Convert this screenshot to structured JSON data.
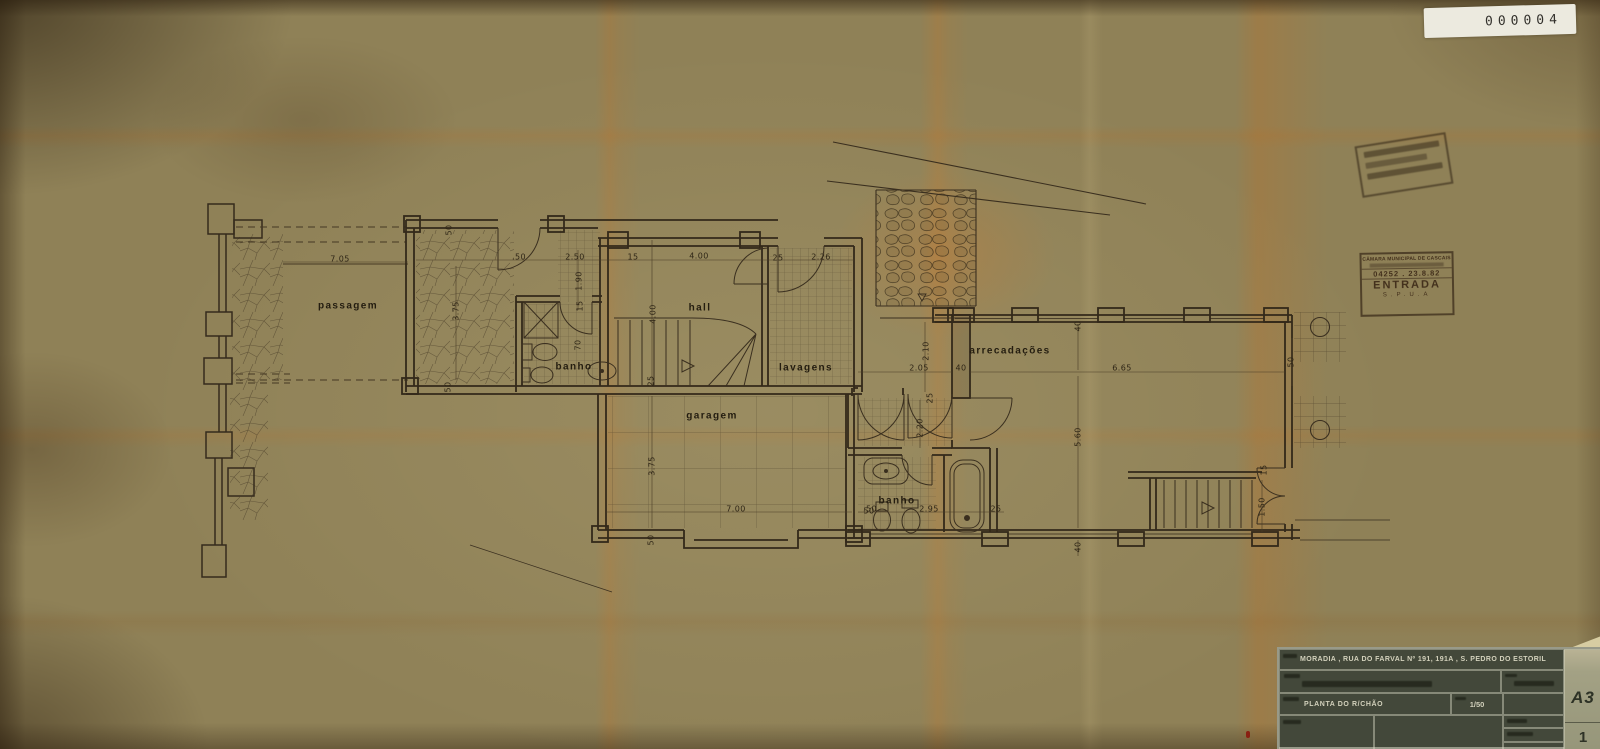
{
  "archive": {
    "number": "000004"
  },
  "stamps": {
    "entry": {
      "line1": "CÂMARA MUNICIPAL DE CASCAIS",
      "line3": "04252 . 23.8.82",
      "line4": "ENTRADA",
      "line5": "S.P.U.A"
    }
  },
  "title_block": {
    "address": "MORADIA , RUA DO FARVAL Nº 191, 191A , S. PEDRO DO ESTORIL",
    "drawing_title": "PLANTA DO R/CHÃO",
    "scale": "1/50",
    "sheet_size": "A3",
    "sheet_number": "1"
  },
  "plan": {
    "rooms": [
      {
        "id": "passagem",
        "t": "passagem",
        "x": 348,
        "y": 306
      },
      {
        "id": "banho-1",
        "t": "banho",
        "x": 574,
        "y": 367
      },
      {
        "id": "hall",
        "t": "hall",
        "x": 700,
        "y": 308
      },
      {
        "id": "lavagens",
        "t": "lavagens",
        "x": 806,
        "y": 368
      },
      {
        "id": "garagem",
        "t": "garagem",
        "x": 712,
        "y": 416
      },
      {
        "id": "arrecadacoes",
        "t": "arrecadações",
        "x": 1010,
        "y": 351
      },
      {
        "id": "banho-2",
        "t": "banho",
        "x": 897,
        "y": 501
      }
    ],
    "dimensions": [
      {
        "t": "7.05",
        "x": 340,
        "y": 259
      },
      {
        "t": "50",
        "x": 449,
        "y": 230,
        "v": 1
      },
      {
        "t": ".50",
        "x": 519,
        "y": 257
      },
      {
        "t": "2.50",
        "x": 575,
        "y": 257
      },
      {
        "t": "1.90",
        "x": 579,
        "y": 281,
        "v": 1
      },
      {
        "t": "3.75",
        "x": 456,
        "y": 311,
        "v": 1
      },
      {
        "t": "15",
        "x": 580,
        "y": 306,
        "v": 1
      },
      {
        "t": "70",
        "x": 578,
        "y": 345,
        "v": 1
      },
      {
        "t": "15",
        "x": 633,
        "y": 257
      },
      {
        "t": "4.00",
        "x": 699,
        "y": 256
      },
      {
        "t": "25",
        "x": 778,
        "y": 258
      },
      {
        "t": "2.26",
        "x": 821,
        "y": 257
      },
      {
        "t": "4.00",
        "x": 653,
        "y": 314,
        "v": 1
      },
      {
        "t": "25",
        "x": 651,
        "y": 381,
        "v": 1
      },
      {
        "t": "50",
        "x": 448,
        "y": 387,
        "v": 1
      },
      {
        "t": "3.75",
        "x": 652,
        "y": 466,
        "v": 1
      },
      {
        "t": "7.00",
        "x": 736,
        "y": 509
      },
      {
        "t": "50",
        "x": 869,
        "y": 511
      },
      {
        "t": "50",
        "x": 651,
        "y": 540,
        "v": 1
      },
      {
        "t": "2.05",
        "x": 919,
        "y": 368
      },
      {
        "t": "2.10",
        "x": 926,
        "y": 351,
        "v": 1
      },
      {
        "t": "25",
        "x": 930,
        "y": 398,
        "v": 1
      },
      {
        "t": "40",
        "x": 961,
        "y": 368
      },
      {
        "t": "6.65",
        "x": 1122,
        "y": 368
      },
      {
        "t": "40",
        "x": 1078,
        "y": 326,
        "v": 1
      },
      {
        "t": "50",
        "x": 1291,
        "y": 362,
        "v": 1
      },
      {
        "t": "5.60",
        "x": 1078,
        "y": 437,
        "v": 1
      },
      {
        "t": "40",
        "x": 1078,
        "y": 547,
        "v": 1
      },
      {
        "t": "2.20",
        "x": 920,
        "y": 428,
        "v": 1
      },
      {
        "t": ".50",
        "x": 870,
        "y": 509
      },
      {
        "t": "2.95",
        "x": 929,
        "y": 509
      },
      {
        "t": "25",
        "x": 996,
        "y": 509
      },
      {
        "t": "1.50",
        "x": 1262,
        "y": 507,
        "v": 1
      },
      {
        "t": "15",
        "x": 1264,
        "y": 470,
        "v": 1
      }
    ]
  }
}
